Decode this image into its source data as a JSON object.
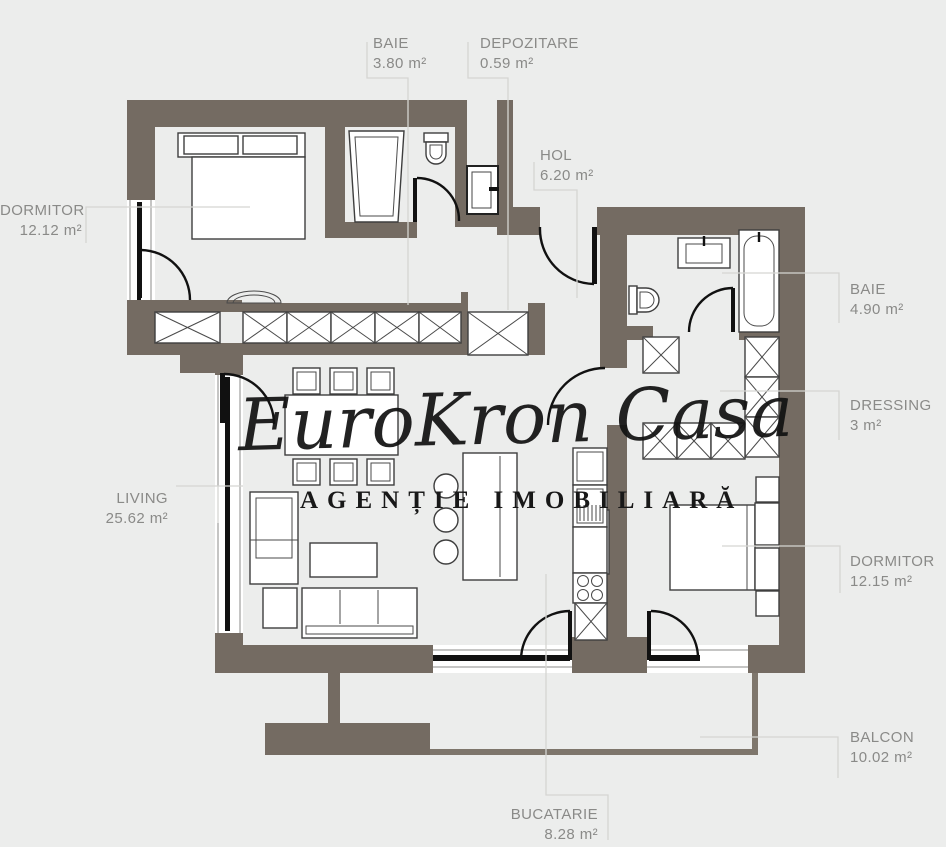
{
  "plan": {
    "rooms": [
      {
        "id": "dormitor1",
        "name": "DORMITOR",
        "area": "12.12 m²"
      },
      {
        "id": "baie1",
        "name": "BAIE",
        "area": "3.80 m²"
      },
      {
        "id": "depozitare",
        "name": "DEPOZITARE",
        "area": "0.59 m²"
      },
      {
        "id": "hol",
        "name": "HOL",
        "area": "6.20 m²"
      },
      {
        "id": "baie2",
        "name": "BAIE",
        "area": "4.90 m²"
      },
      {
        "id": "dressing",
        "name": "DRESSING",
        "area": "3 m²"
      },
      {
        "id": "dormitor2",
        "name": "DORMITOR",
        "area": "12.15 m²"
      },
      {
        "id": "living",
        "name": "LIVING",
        "area": "25.62 m²"
      },
      {
        "id": "bucatarie",
        "name": "BUCATARIE",
        "area": "8.28 m²"
      },
      {
        "id": "balcon",
        "name": "BALCON",
        "area": "10.02 m²"
      }
    ],
    "watermark": {
      "script_text": "EuroKron Casa",
      "subtitle": "AGENȚIE IMOBILIARĂ"
    },
    "colors": {
      "background": "#ecedec",
      "wall": "#746b62",
      "wall_thin": "#7e766c",
      "furniture_line": "#3e3e3e",
      "door": "#111111",
      "label_text": "#8a8a88",
      "leader_line": "#d5d5d2",
      "watermark_text": "#121212"
    }
  }
}
